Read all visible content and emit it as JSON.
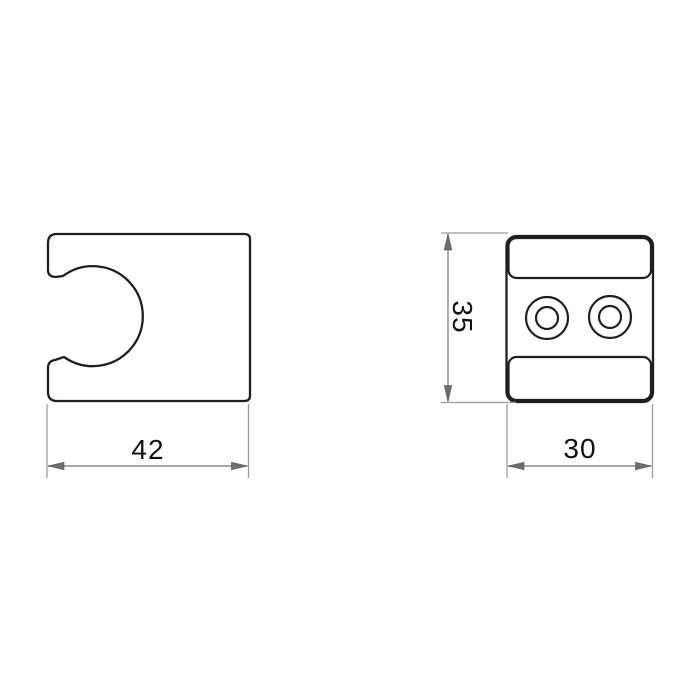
{
  "drawing": {
    "views": {
      "front": {
        "width_label": "42"
      },
      "side": {
        "height_label": "35",
        "width_label": "30"
      }
    },
    "colors": {
      "background": "#ffffff",
      "outline": "#1f1f1f",
      "dimension_line": "#8c8c8c",
      "label_text": "#111111"
    }
  }
}
